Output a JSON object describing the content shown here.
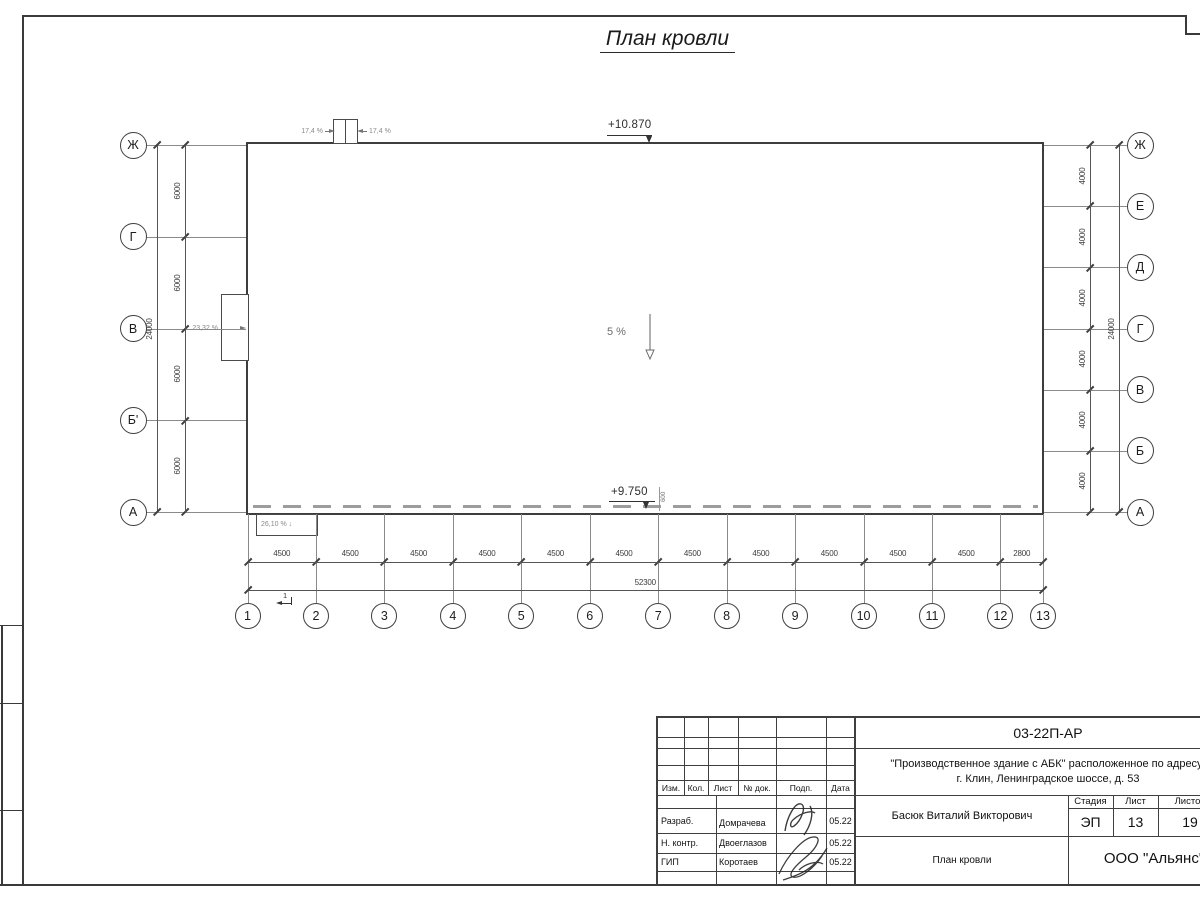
{
  "page": {
    "title": "План кровли"
  },
  "plan": {
    "elevation_top": "+10.870",
    "elevation_bottom": "+9.750",
    "parapet_offset": "600",
    "slope_center": "5 %",
    "slope_left": "23,32 %",
    "slope_bottom": "26,10 %",
    "slope_bottom_arrow": "↓",
    "slope_hatch_left": "17,4 %",
    "slope_hatch_right": "17,4 %",
    "section_mark": "1",
    "columns": {
      "labels": [
        "1",
        "2",
        "3",
        "4",
        "5",
        "6",
        "7",
        "8",
        "9",
        "10",
        "11",
        "12",
        "13"
      ],
      "spacings": [
        "4500",
        "4500",
        "4500",
        "4500",
        "4500",
        "4500",
        "4500",
        "4500",
        "4500",
        "4500",
        "4500",
        "2800"
      ],
      "total": "52300"
    },
    "rows_left": {
      "labels": [
        "Ж",
        "Г",
        "В",
        "Б'",
        "А"
      ],
      "spacings": [
        "6000",
        "6000",
        "6000",
        "6000"
      ],
      "total": "24000"
    },
    "rows_right": {
      "labels": [
        "Ж",
        "Е",
        "Д",
        "Г",
        "В",
        "Б",
        "А"
      ],
      "spacings": [
        "4000",
        "4000",
        "4000",
        "4000",
        "4000",
        "4000"
      ],
      "total": "24000"
    }
  },
  "titleblock": {
    "doc_code": "03-22П-АР",
    "project_line1": "\"Производственное здание с АБК\" расположенное по адресу:",
    "project_line2": "г. Клин, Ленинградское шоссе, д. 53",
    "header": {
      "izm": "Изм.",
      "kol": "Кол.",
      "list": "Лист",
      "doc": "№ док.",
      "podp": "Подп.",
      "data": "Дата"
    },
    "rows": [
      {
        "role": "Разраб.",
        "name": "Домрачева",
        "date": "05.22"
      },
      {
        "role": "Н. контр.",
        "name": "Двоеглазов",
        "date": "05.22"
      },
      {
        "role": "ГИП",
        "name": "Коротаев",
        "date": "05.22"
      }
    ],
    "approver": "Басюк Виталий Викторович",
    "stage_label": "Стадия",
    "sheet_label": "Лист",
    "sheets_label": "Листов",
    "stage": "ЭП",
    "sheet": "13",
    "sheets": "19",
    "drawing_name": "План кровли",
    "company": "ООО \"Альянс\""
  },
  "colors": {
    "line_dark": "#3d3d3d",
    "line_gray": "#8a8a8a",
    "dash_gray": "#9d9d9d",
    "text": "#1c1c1c"
  }
}
